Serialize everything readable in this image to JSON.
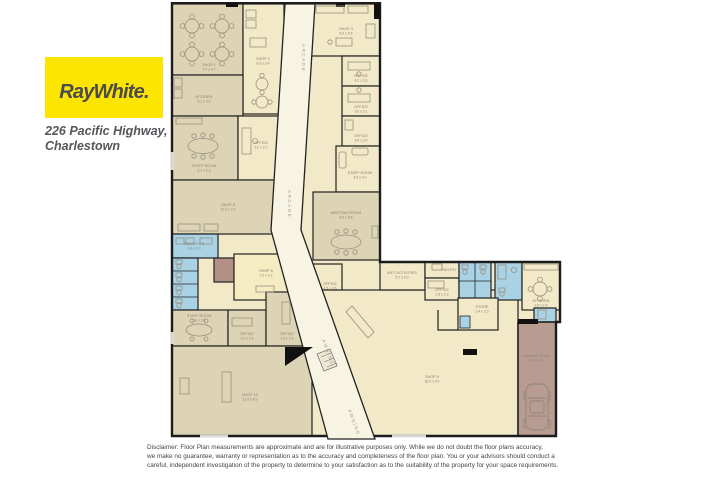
{
  "brand": {
    "logo_text": "RayWhite.",
    "address_line1": "226 Pacific Highway,",
    "address_line2": "Charlestown"
  },
  "colors": {
    "logo_yellow": "#fce500",
    "logo_text": "#4b4b4d",
    "wall": "#222222",
    "cream": "#f2e9c8",
    "taupe": "#ddd4b6",
    "corridor": "#f8f4e3",
    "blue": "#a9d2e5",
    "mauve": "#b29086",
    "dock": "#b89c91",
    "label": "#8b8274"
  },
  "floorplan": {
    "corridor_label": "ARCADE",
    "awning_label": "AWNING",
    "rooms": [
      {
        "name": "SHOP 1",
        "dims": "7.0 x 4.7"
      },
      {
        "name": "SHOP 2",
        "dims": "8.3 x 3.4"
      },
      {
        "name": "KITCHEN",
        "dims": "5.1 x 3.6"
      },
      {
        "name": "STAFF ROOM",
        "dims": "6.1 x 3.3"
      },
      {
        "name": "OFFICE",
        "dims": "3.0 x 2.7"
      },
      {
        "name": "SHOP 5",
        "dims": "10.2 x 7.0"
      },
      {
        "name": "AMENITIES",
        "dims": "4.6 x 2.0"
      },
      {
        "name": "SHOP 6",
        "dims": "7.0 x 4.2"
      },
      {
        "name": "STAFF ROOM",
        "dims": "5.6 x 3.1"
      },
      {
        "name": "OFFICE",
        "dims": "3.0 x 2.5"
      },
      {
        "name": "OFFICE",
        "dims": "2.8 x 2.4"
      },
      {
        "name": "SHOP 10",
        "dims": "12.0 x 8.5"
      },
      {
        "name": "SHOP 3",
        "dims": "8.0 x 5.5"
      },
      {
        "name": "OFFICE",
        "dims": "4.2 x 3.6"
      },
      {
        "name": "OFFICE",
        "dims": "3.6 x 3.1"
      },
      {
        "name": "OFFICE",
        "dims": "3.6 x 3.0"
      },
      {
        "name": "STAFF ROOM",
        "dims": "4.5 x 4.0"
      },
      {
        "name": "MEETING ROOM",
        "dims": "6.0 x 3.8"
      },
      {
        "name": "OFFICE",
        "dims": "4.5 x 3.6"
      },
      {
        "name": "WET ACTIVITIES",
        "dims": "5.7 x 3.0"
      },
      {
        "name": "PANTRY",
        "dims": ""
      },
      {
        "name": "OFFICE",
        "dims": "2.8 x 2.3"
      },
      {
        "name": "KITCHEN",
        "dims": "3.5 x 2.8"
      },
      {
        "name": "LOADING DOCK",
        "dims": "10.4 x 3.4"
      },
      {
        "name": "SHOP 9",
        "dims": "18.0 x 9.0"
      },
      {
        "name": "STORE",
        "dims": "2.4 x 2.0"
      }
    ]
  },
  "disclaimer": {
    "line1": "Disclaimer: Floor Plan measurements are approximate and are for illustrative purposes only. While we do not doubt the floor plans accuracy,",
    "line2": "we make no guarantee, warranty or representation as to the accuracy and completeness of the floor plan. You or your advisors should conduct a",
    "line3": "careful, independent investigation of the property to determine to your satisfaction as to the suitability of the property for your space requirements."
  }
}
